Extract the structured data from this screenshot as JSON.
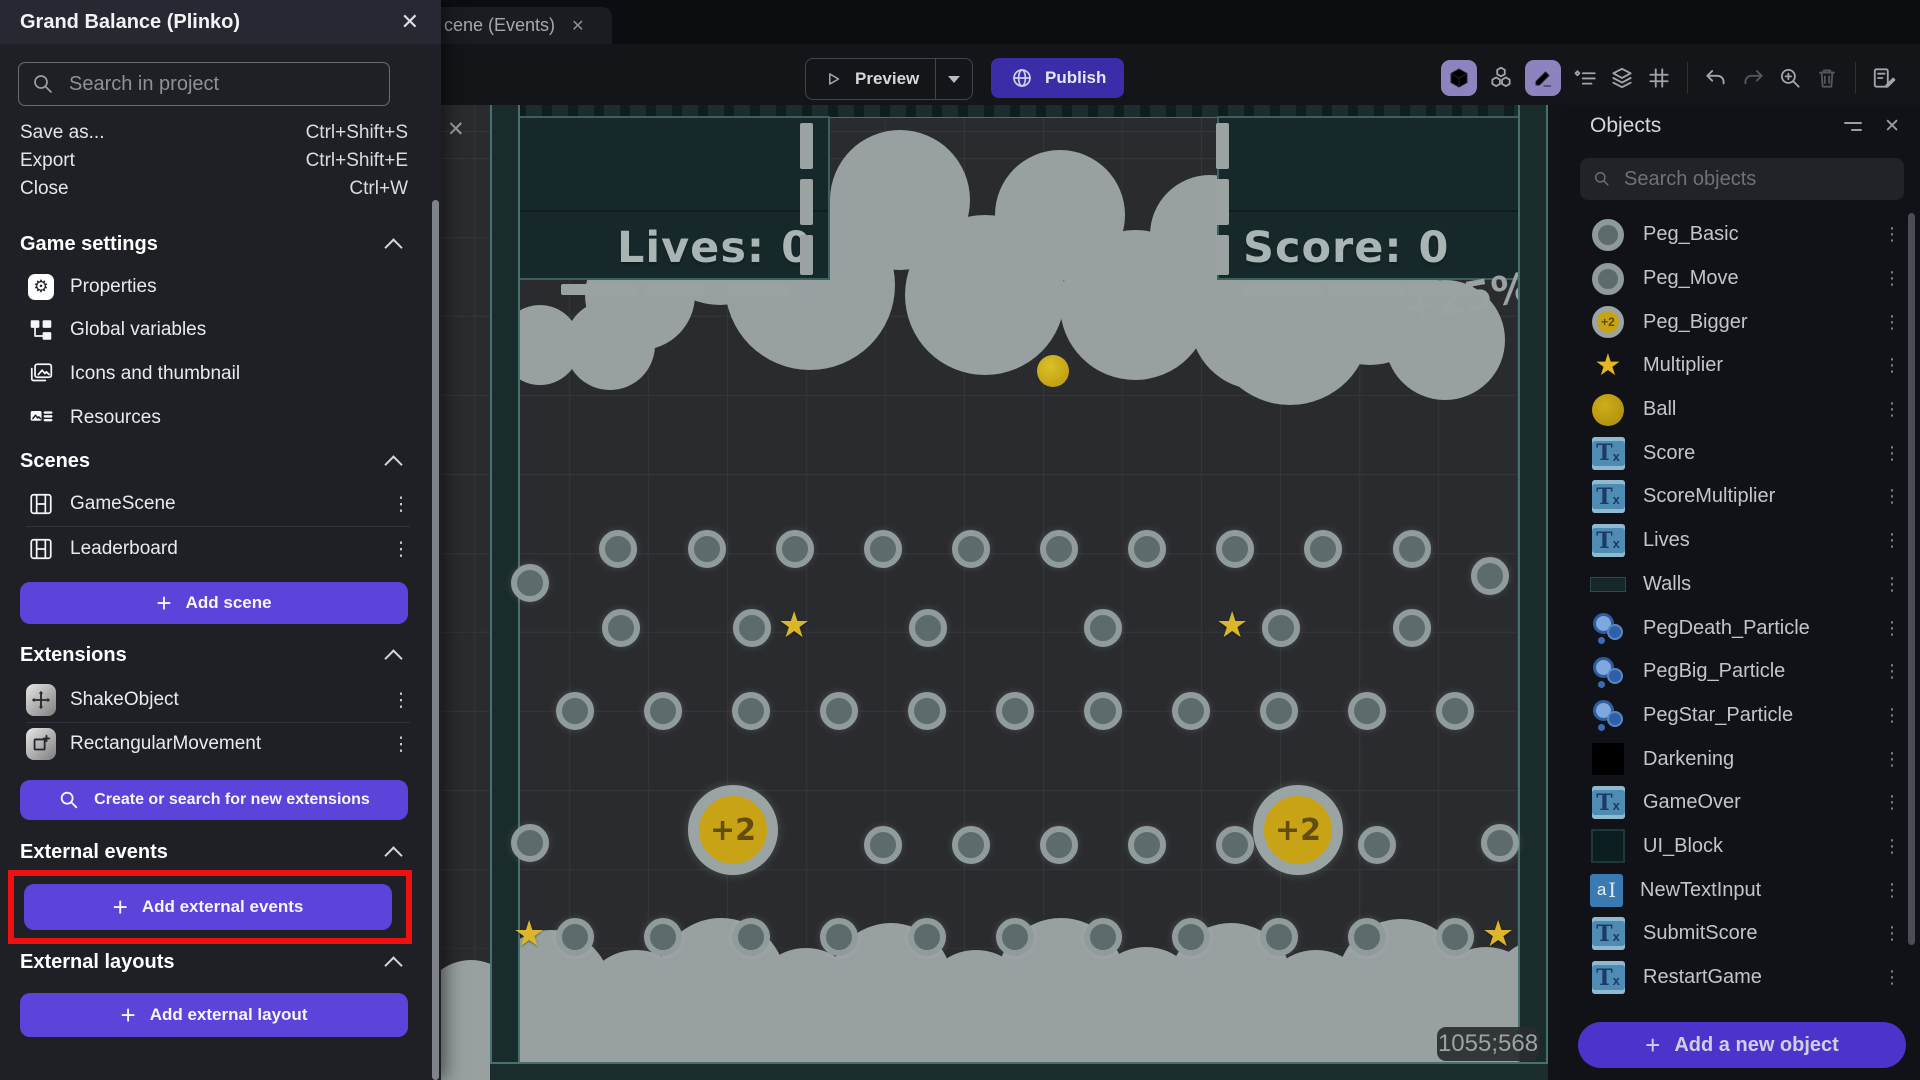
{
  "drawer": {
    "title": "Grand Balance (Plinko)",
    "close_icon": "✕",
    "search_placeholder": "Search in project",
    "menu": [
      {
        "label": "Save as...",
        "shortcut": "Ctrl+Shift+S"
      },
      {
        "label": "Export",
        "shortcut": "Ctrl+Shift+E"
      },
      {
        "label": "Close",
        "shortcut": "Ctrl+W"
      }
    ],
    "game_settings": {
      "label": "Game settings",
      "items": [
        {
          "label": "Properties"
        },
        {
          "label": "Global variables"
        },
        {
          "label": "Icons and thumbnail"
        },
        {
          "label": "Resources"
        }
      ]
    },
    "scenes": {
      "label": "Scenes",
      "items": [
        {
          "label": "GameScene"
        },
        {
          "label": "Leaderboard"
        }
      ],
      "add_button": "Add scene"
    },
    "extensions": {
      "label": "Extensions",
      "items": [
        {
          "label": "ShakeObject"
        },
        {
          "label": "RectangularMovement"
        }
      ],
      "search_button": "Create or search for new extensions"
    },
    "external_events": {
      "label": "External events",
      "add_button": "Add external events"
    },
    "external_layouts": {
      "label": "External layouts",
      "add_button": "Add external layout"
    }
  },
  "topbar": {
    "tab_label": "cene (Events)",
    "tab_close": "✕",
    "preview_label": "Preview",
    "publish_label": "Publish"
  },
  "canvas": {
    "lives_text": "Lives: 0",
    "score_text": "Score: 0",
    "bonus_text": "+25%",
    "cursor_coordinates": "1055;568",
    "coin_label": "+2",
    "close_icon": "✕",
    "pegs": [
      [
        177,
        444
      ],
      [
        266,
        444
      ],
      [
        354,
        444
      ],
      [
        442,
        444
      ],
      [
        530,
        444
      ],
      [
        618,
        444
      ],
      [
        706,
        444
      ],
      [
        794,
        444
      ],
      [
        882,
        444
      ],
      [
        971,
        444
      ],
      [
        89,
        478
      ],
      [
        1049,
        471
      ],
      [
        180,
        523
      ],
      [
        311,
        523
      ],
      [
        487,
        523
      ],
      [
        662,
        523
      ],
      [
        840,
        523
      ],
      [
        971,
        523
      ],
      [
        134,
        606
      ],
      [
        222,
        606
      ],
      [
        310,
        606
      ],
      [
        398,
        606
      ],
      [
        486,
        606
      ],
      [
        574,
        606
      ],
      [
        662,
        606
      ],
      [
        750,
        606
      ],
      [
        838,
        606
      ],
      [
        926,
        606
      ],
      [
        1014,
        606
      ],
      [
        89,
        738
      ],
      [
        442,
        740
      ],
      [
        530,
        740
      ],
      [
        618,
        740
      ],
      [
        706,
        740
      ],
      [
        794,
        740
      ],
      [
        936,
        740
      ],
      [
        1059,
        738
      ],
      [
        134,
        832
      ],
      [
        222,
        832
      ],
      [
        310,
        832
      ],
      [
        398,
        832
      ],
      [
        486,
        832
      ],
      [
        574,
        832
      ],
      [
        662,
        832
      ],
      [
        750,
        832
      ],
      [
        838,
        832
      ],
      [
        926,
        832
      ],
      [
        1014,
        832
      ]
    ],
    "stars": [
      [
        355,
        523
      ],
      [
        793,
        523
      ],
      [
        90,
        832
      ],
      [
        1059,
        832
      ]
    ],
    "coins": [
      [
        292,
        725
      ],
      [
        857,
        725
      ]
    ],
    "ball": [
      612,
      266
    ]
  },
  "objects_panel": {
    "title": "Objects",
    "close_icon": "✕",
    "search_placeholder": "Search objects",
    "add_button": "Add a new object",
    "items": [
      {
        "name": "Peg_Basic",
        "icon": "peg"
      },
      {
        "name": "Peg_Move",
        "icon": "peg"
      },
      {
        "name": "Peg_Bigger",
        "icon": "peg-big"
      },
      {
        "name": "Multiplier",
        "icon": "star"
      },
      {
        "name": "Ball",
        "icon": "ball"
      },
      {
        "name": "Score",
        "icon": "text"
      },
      {
        "name": "ScoreMultiplier",
        "icon": "text"
      },
      {
        "name": "Lives",
        "icon": "text"
      },
      {
        "name": "Walls",
        "icon": "wall"
      },
      {
        "name": "PegDeath_Particle",
        "icon": "particle"
      },
      {
        "name": "PegBig_Particle",
        "icon": "particle"
      },
      {
        "name": "PegStar_Particle",
        "icon": "particle"
      },
      {
        "name": "Darkening",
        "icon": "dark"
      },
      {
        "name": "GameOver",
        "icon": "text"
      },
      {
        "name": "UI_Block",
        "icon": "uiblock"
      },
      {
        "name": "NewTextInput",
        "icon": "textinput"
      },
      {
        "name": "SubmitScore",
        "icon": "text"
      },
      {
        "name": "RestartGame",
        "icon": "text"
      }
    ]
  },
  "toolbar_icons": [
    "3d-view",
    "3d-objects",
    "edit",
    "instances-list",
    "layers",
    "grid",
    "undo",
    "redo",
    "zoom-in",
    "trash",
    "events-sheet"
  ],
  "colors": {
    "accent_purple": "#5c43da",
    "publish_purple": "#3b2ca8",
    "annotation_red": "#ee1111",
    "canvas_teal": "#16282a",
    "cloud_gray": "#98a0a0",
    "gold": "#c7a315"
  }
}
